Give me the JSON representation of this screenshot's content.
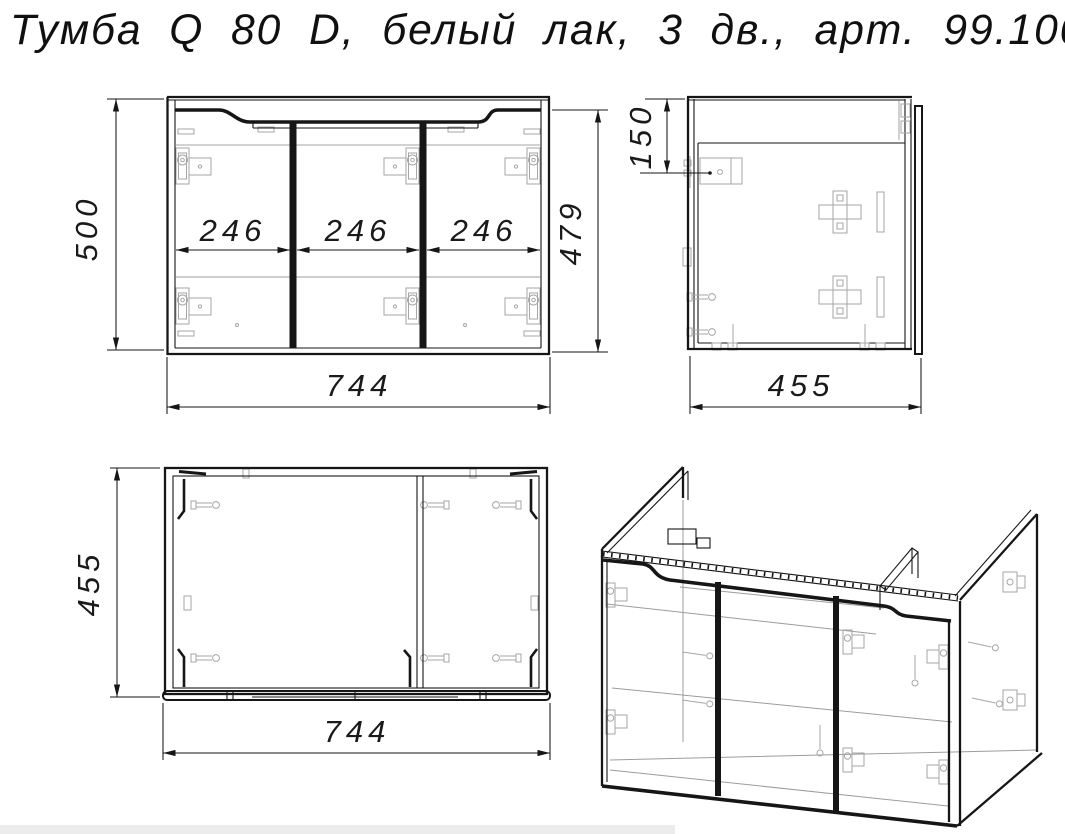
{
  "title": "Тумба Q 80 D, белый лак, 3 дв., арт. 99.1003",
  "colors": {
    "line": "#161616",
    "hardware": "#a6a6a6",
    "background": "#ffffff"
  },
  "views": {
    "front": {
      "overall_height": "500",
      "door_height": "479",
      "door_widths": [
        "246",
        "246",
        "246"
      ],
      "overall_width": "744"
    },
    "side": {
      "hanger_offset": "150",
      "overall_depth": "455"
    },
    "top": {
      "overall_depth": "455",
      "overall_width": "744"
    }
  }
}
